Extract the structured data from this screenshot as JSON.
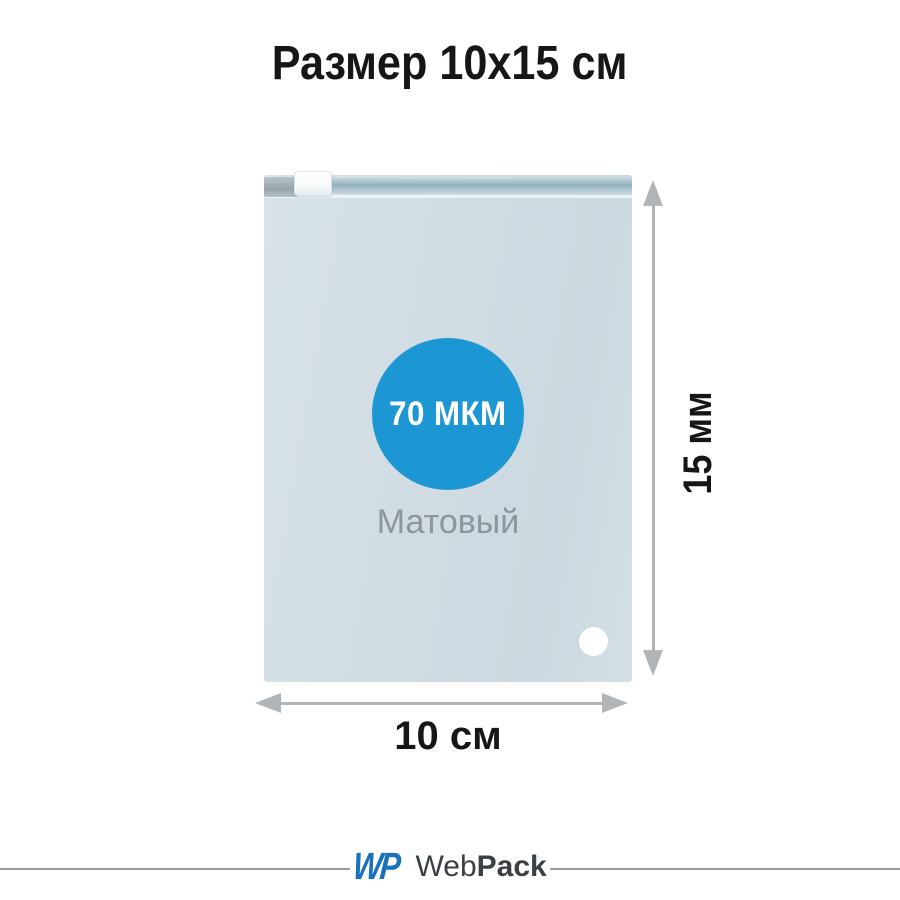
{
  "title": "Размер 10х15 см",
  "bag": {
    "thickness_label": "70 МКМ",
    "finish_label": "Матовый",
    "badge_color": "#1d96d4",
    "body_color": "#d1dde3"
  },
  "dimensions": {
    "height_label": "15 мм",
    "width_label": "10 см",
    "arrow_color": "#b2b5b7",
    "label_color": "#161616"
  },
  "footer": {
    "logo_mark": "WP",
    "brand_web": "Web",
    "brand_pack": "Pack",
    "logo_color": "#1a71bc",
    "brand_text_color": "#3b4046"
  }
}
